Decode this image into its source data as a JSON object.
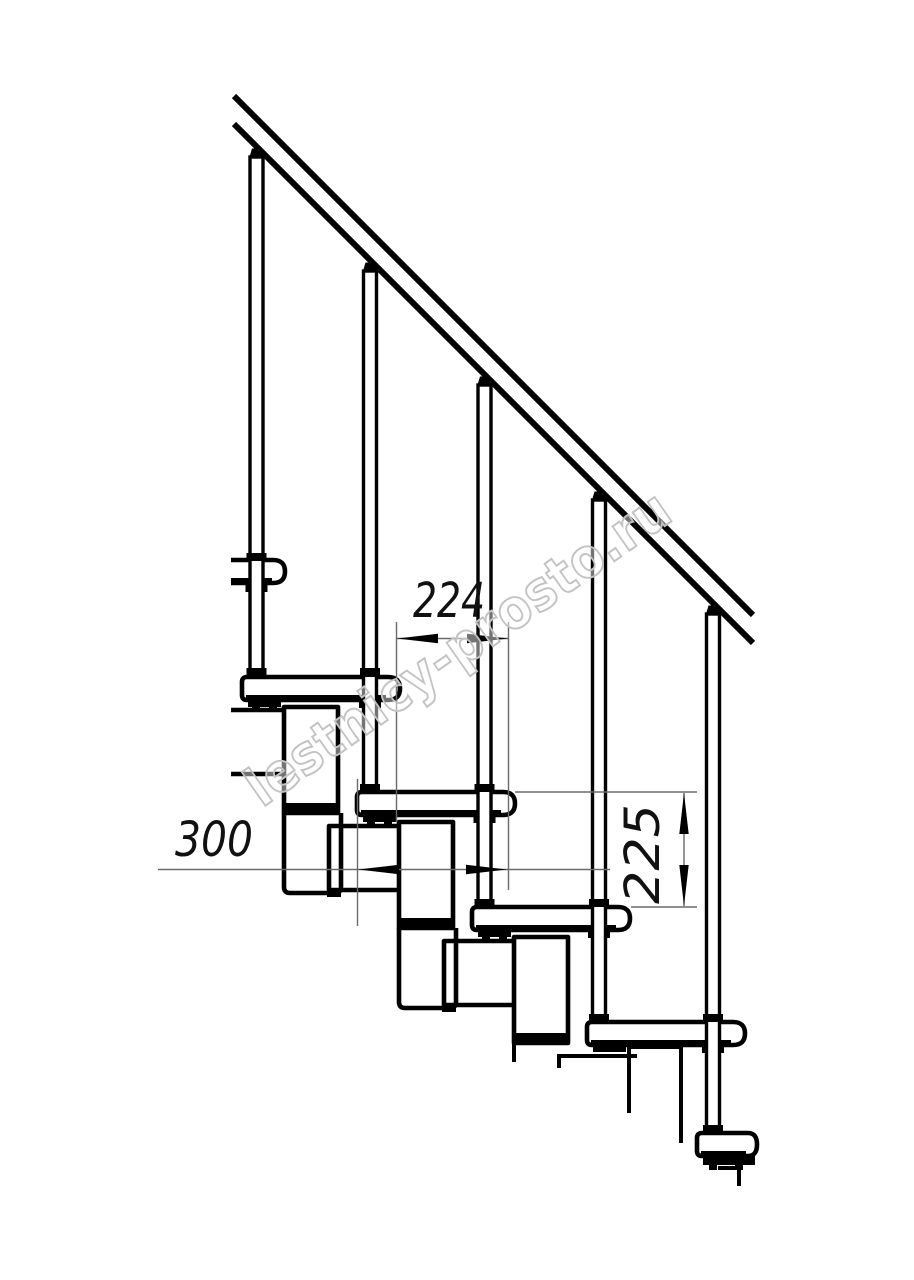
{
  "drawing": {
    "title": "modular-staircase-side-elevation",
    "watermark_text": "lestnicy-prosto.ru",
    "dimensions": {
      "going_label": "224",
      "module_length_label": "300",
      "rise_label": "225"
    },
    "colors": {
      "line": "#000000",
      "dimension": "#6a6a6a",
      "text": "#111111",
      "watermark": "#c3c3c3",
      "background": "#ffffff"
    },
    "elements": {
      "handrail_count": 1,
      "baluster_count": 5,
      "tread_count": 6,
      "module_count": 5
    }
  }
}
